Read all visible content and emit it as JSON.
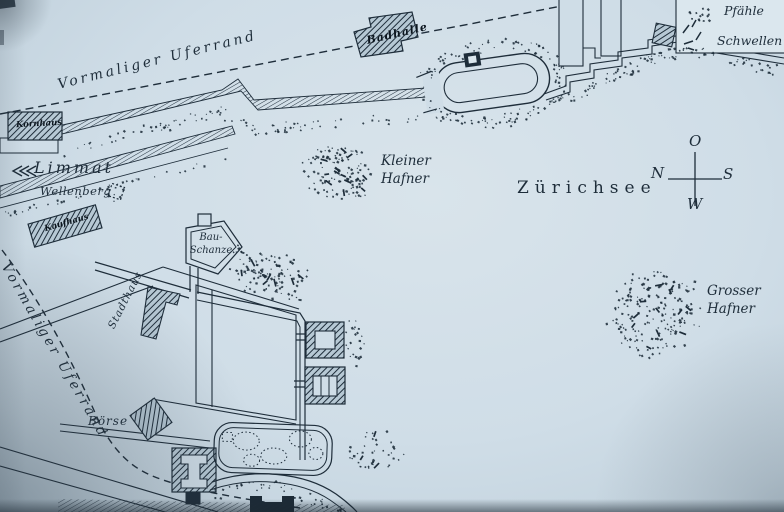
{
  "map": {
    "labels": {
      "former_shore_top": "Vormaliger Uferrand",
      "former_shore_left": "Vormaliger Uferrand",
      "river": "Limmat",
      "wellenberg": "Wellenberg",
      "lake": "Zürichsee",
      "kleiner_hafner": {
        "line1": "Kleiner",
        "line2": "Hafner"
      },
      "grosser_hafner": {
        "line1": "Grosser",
        "line2": "Hafner"
      },
      "bau_schanze": {
        "line1": "Bau-",
        "line2": "Schanze"
      },
      "stadthaus": "Stadthaus",
      "boerse": "Börse",
      "badhalle": "Badhalle",
      "kornhaus": "Kornhaus",
      "kaufhaus": "Kaufhaus"
    },
    "compass": {
      "top": "O",
      "left": "N",
      "right": "S",
      "bottom": "W"
    },
    "legend": {
      "items": [
        {
          "symbol": "piles-dots",
          "label": "Pfähle"
        },
        {
          "symbol": "sills-ticks",
          "label": "Schwellen"
        }
      ]
    },
    "colors": {
      "paper": "#cfdde7",
      "ink": "#1e2d3a"
    }
  }
}
